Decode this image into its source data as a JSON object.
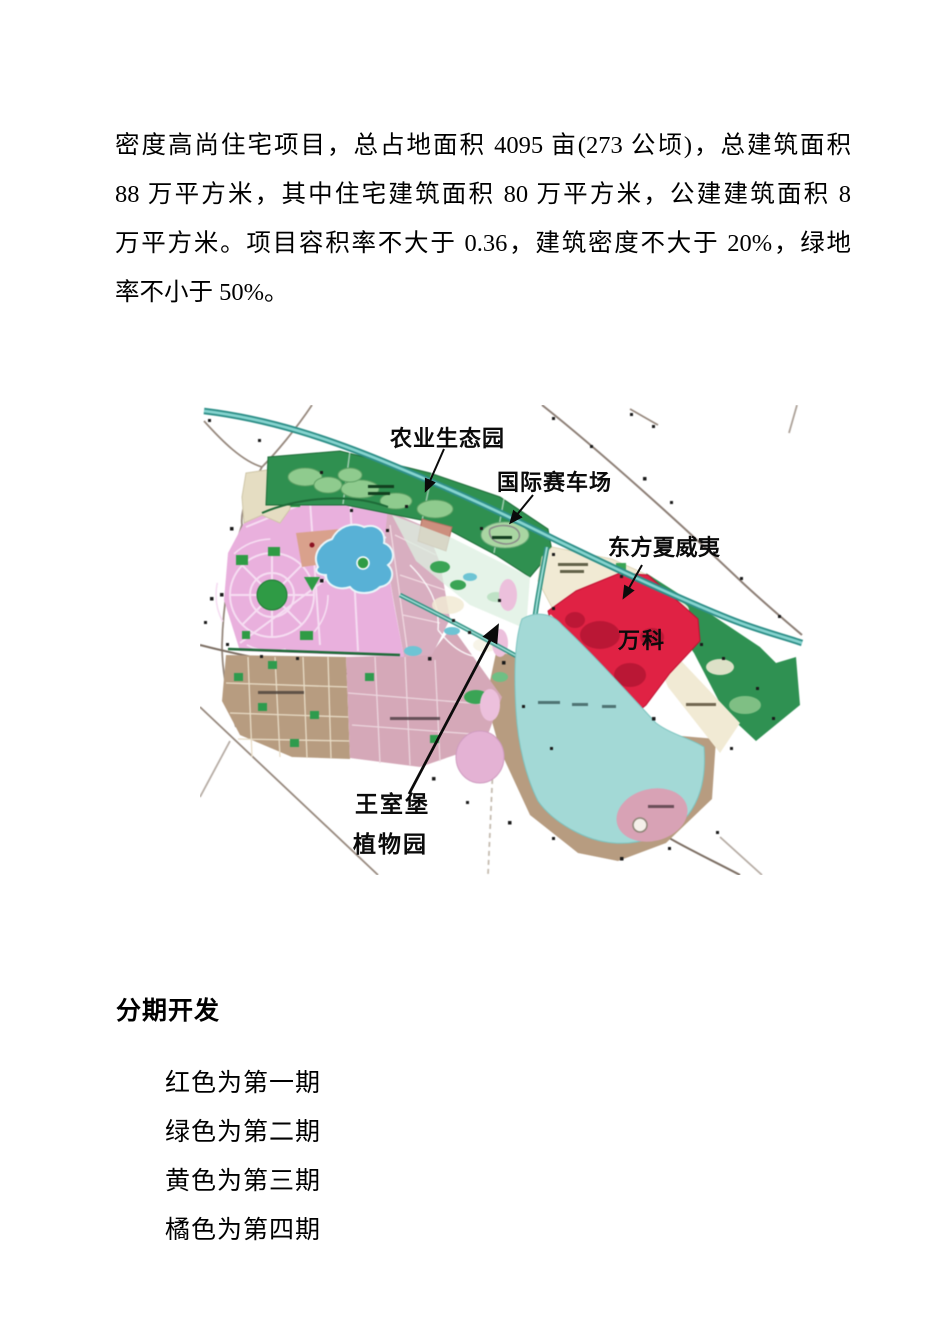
{
  "document": {
    "paragraph_lines": [
      "密度高尚住宅项目，总占地面积 4095 亩(273 公顷)，总建筑面积",
      "88 万平方米，其中住宅建筑面积 80 万平方米，公建建筑面积 8",
      "万平方米。项目容积率不大于 0.36，建筑密度不大于 20%，绿地",
      "率不小于 50%。"
    ],
    "section_heading": "分期开发",
    "phase_list": [
      "红色为第一期",
      "绿色为第二期",
      "黄色为第三期",
      "橘色为第四期"
    ]
  },
  "map": {
    "labels": {
      "agri_park": "农业生态园",
      "racing": "国际赛车场",
      "hawaii": "东方夏威夷",
      "vanke": "万科",
      "royal_castle": "王室堡",
      "botanical": "植物园"
    },
    "colors": {
      "phase1_red": "#e02244",
      "strip_green": "#2f9050",
      "park_pink": "#e9b0dd",
      "lake_cyan": "#a3d9d6",
      "pond_blue": "#58b1d6",
      "tan_brown": "#b79c80",
      "rose": "#d8aec0",
      "cream": "#f1ead4",
      "river_teal": "#2e8f88"
    }
  }
}
